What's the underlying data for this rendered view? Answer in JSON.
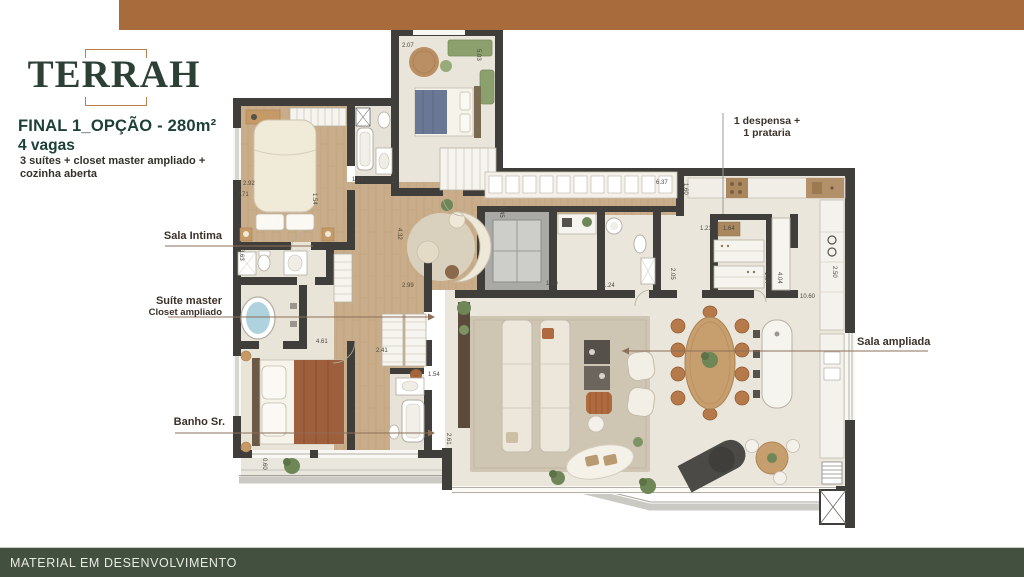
{
  "header": {
    "logo_text": "TERRAH",
    "title": "FINAL 1_OPÇÃO - 280m²",
    "subtitle": "4 vagas",
    "description_line1": "3 suítes + closet master ampliado +",
    "description_line2": "cozinha aberta"
  },
  "plan_labels": {
    "sala_intima": "Sala Intima",
    "suite_master": "Suíte master",
    "closet_ampliado": "Closet ampliado",
    "banho_sr": "Banho Sr.",
    "despensa_line1": "1 despensa +",
    "despensa_line2": "1 prataria",
    "sala_ampliada": "Sala ampliada"
  },
  "dimensions": [
    "2.92",
    "2.71",
    "1.54",
    "3.63",
    "1.61",
    "2.61",
    "2.07",
    "5.03",
    "6.37",
    "1.60",
    "4.32",
    "2.99",
    "1.45",
    "1.50",
    "1.24",
    "2.05",
    "1.21",
    "1.64",
    "1.04",
    "4.04",
    "10.60",
    "2.50",
    "4.61",
    "2.41",
    "1.54",
    "2.61",
    "0.60"
  ],
  "footer": {
    "text": "MATERIAL EM DESENVOLVIMENTO"
  },
  "colors": {
    "top_bar": "#a86c3c",
    "logo_green": "#2d4035",
    "accent_copper": "#b5824f",
    "title_green": "#1d4039",
    "footer_bg": "#44503f"
  }
}
